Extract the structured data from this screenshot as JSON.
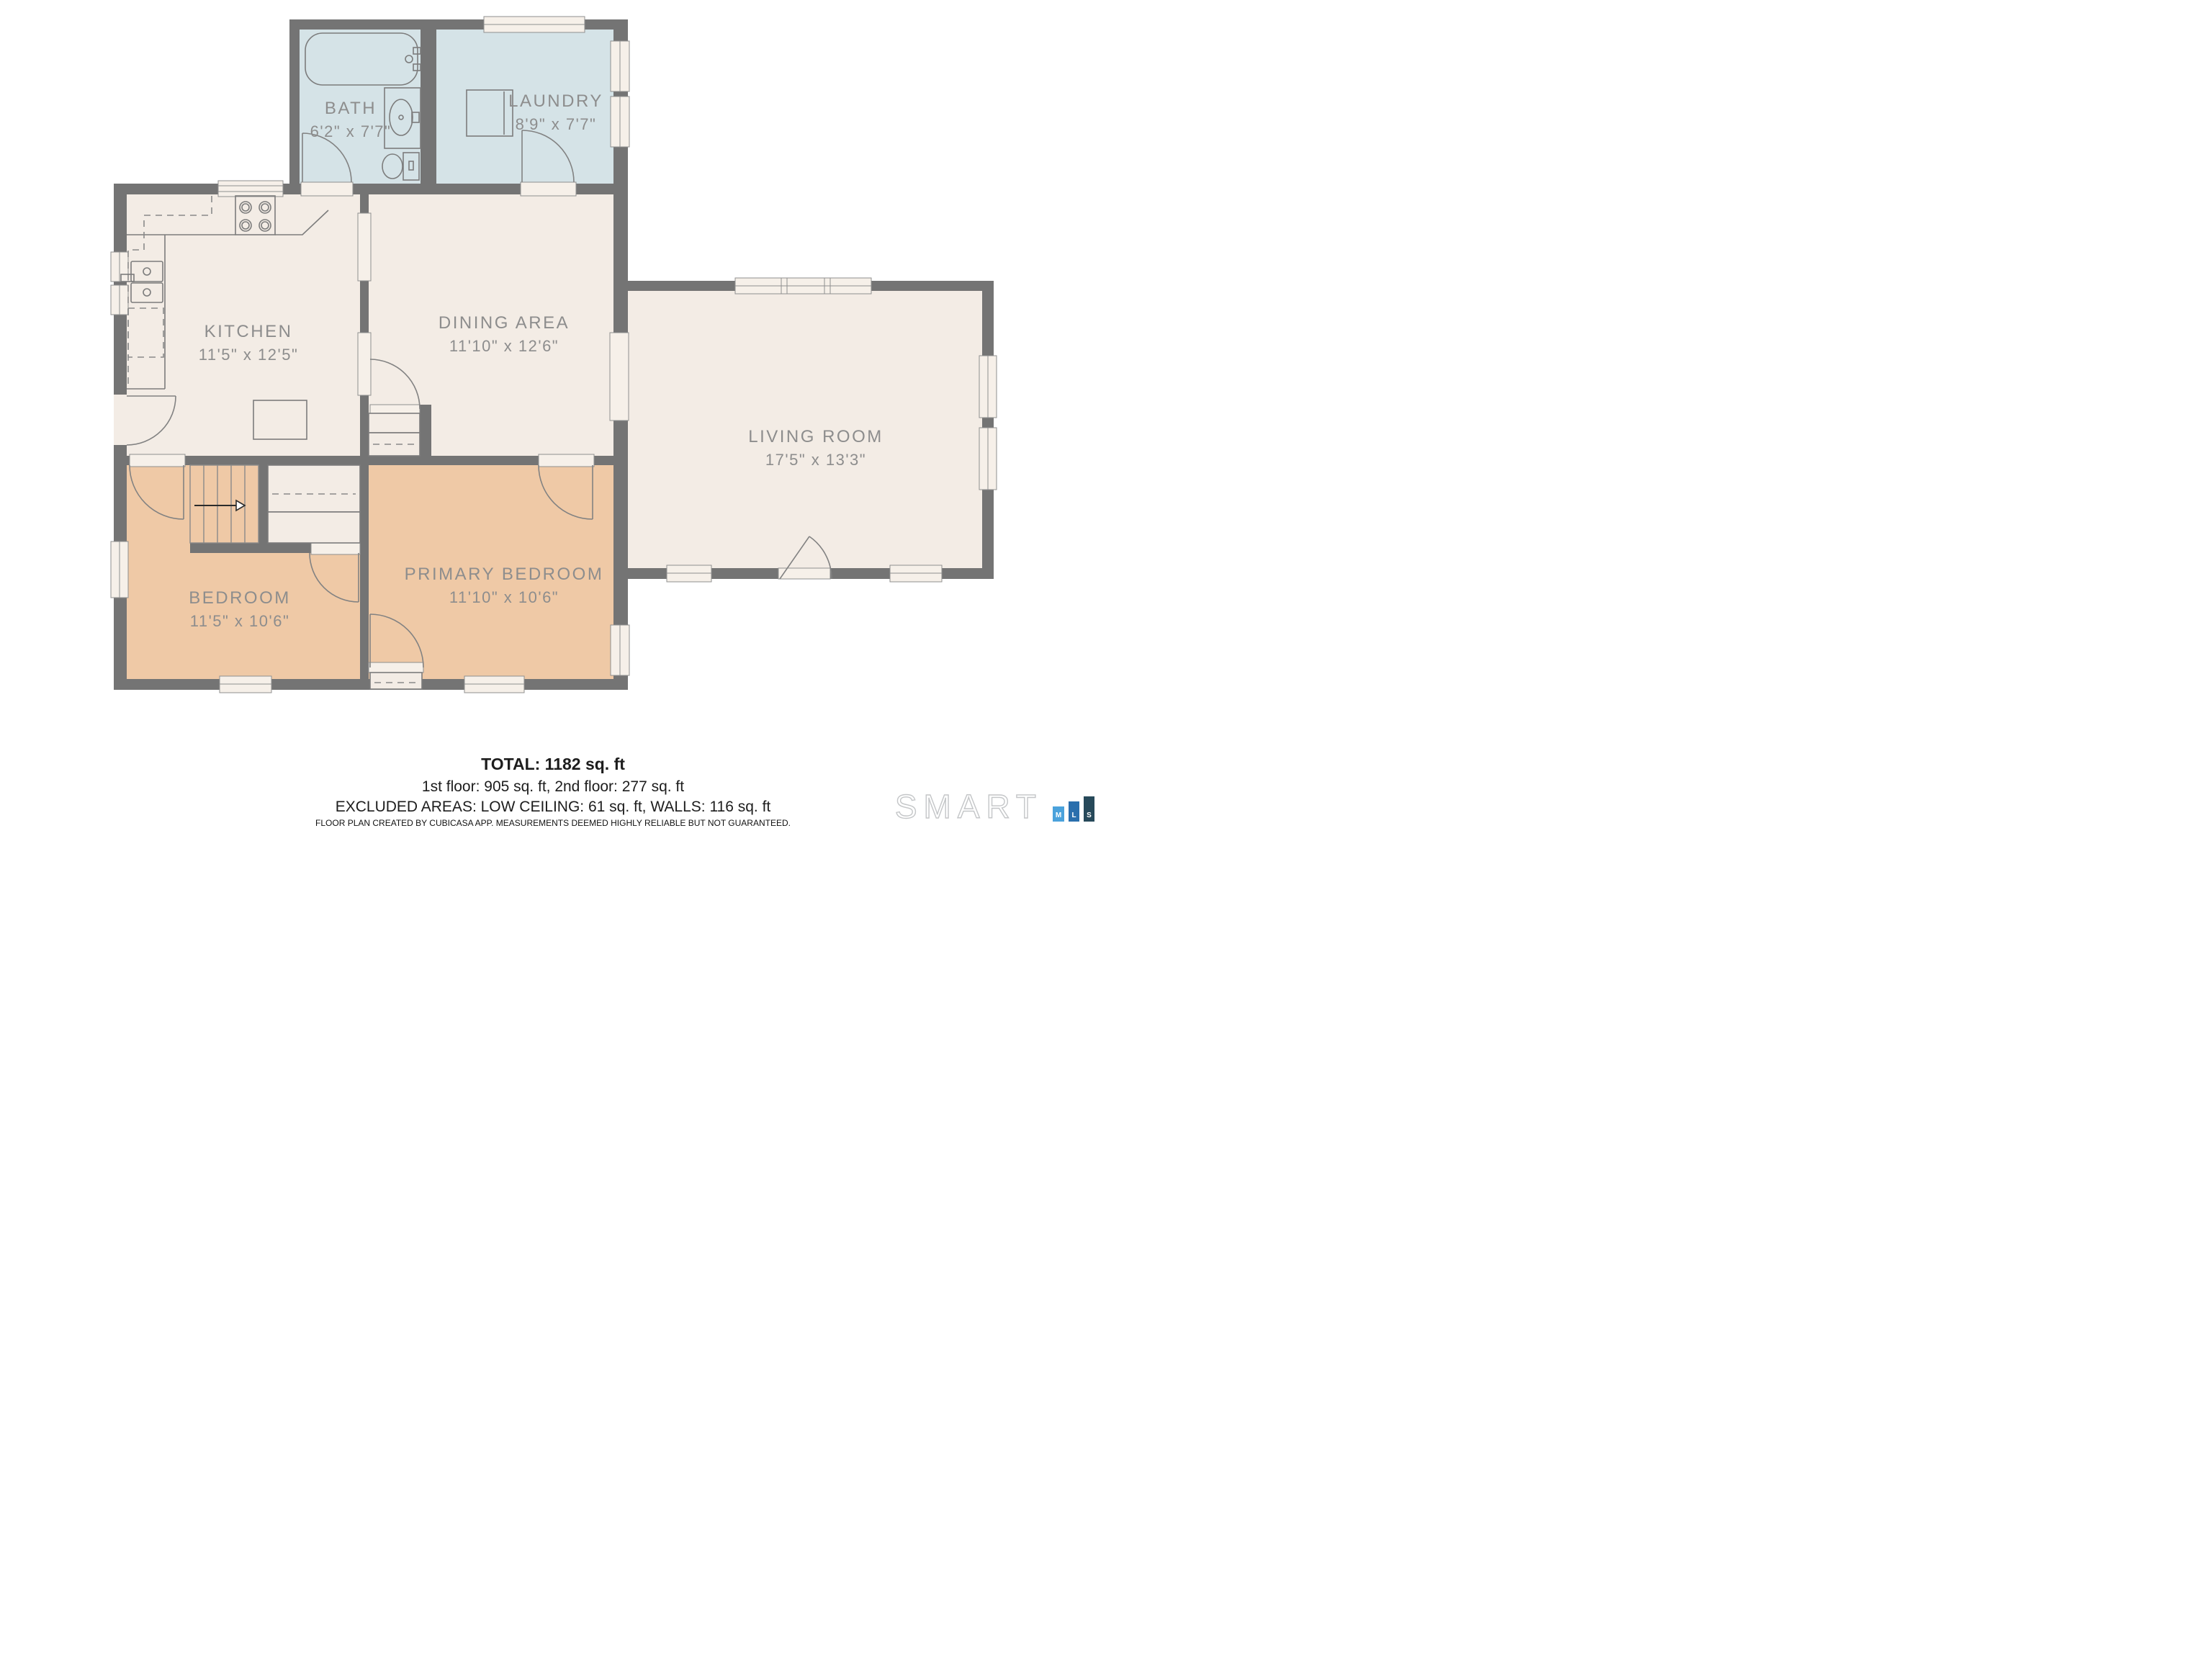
{
  "colors": {
    "wall": "#747474",
    "cream": "#f3ece5",
    "blue": "#d5e3e7",
    "tan": "#efc9a6",
    "window": "#f6f0e9",
    "line": "#7c7c7c",
    "label": "#8d8d8d",
    "text": "#1d1d1d",
    "logoM": "#4aa2dc",
    "logoL": "#2a6fad",
    "logoS": "#27495a",
    "logoOutline": "#c4c6c8"
  },
  "rooms": [
    {
      "id": "bath",
      "name": "BATH",
      "dims": "6'2\" x 7'7\""
    },
    {
      "id": "laundry",
      "name": "LAUNDRY",
      "dims": "8'9\" x 7'7\""
    },
    {
      "id": "kitchen",
      "name": "KITCHEN",
      "dims": "11'5\" x 12'5\""
    },
    {
      "id": "dining",
      "name": "DINING AREA",
      "dims": "11'10\" x 12'6\""
    },
    {
      "id": "living",
      "name": "LIVING ROOM",
      "dims": "17'5\" x 13'3\""
    },
    {
      "id": "bedroom",
      "name": "BEDROOM",
      "dims": "11'5\" x 10'6\""
    },
    {
      "id": "primary",
      "name": "PRIMARY BEDROOM",
      "dims": "11'10\" x 10'6\""
    }
  ],
  "summary": {
    "total": "TOTAL: 1182 sq. ft",
    "floors": "1st floor: 905 sq. ft, 2nd floor: 277 sq. ft",
    "excluded": "EXCLUDED AREAS: LOW CEILING: 61 sq. ft, WALLS: 116 sq. ft"
  },
  "disclaimer": "FLOOR PLAN CREATED BY CUBICASA APP. MEASUREMENTS DEEMED HIGHLY RELIABLE BUT NOT GUARANTEED.",
  "logo": {
    "brand": "SMART",
    "bars": [
      "M",
      "L",
      "S"
    ]
  }
}
